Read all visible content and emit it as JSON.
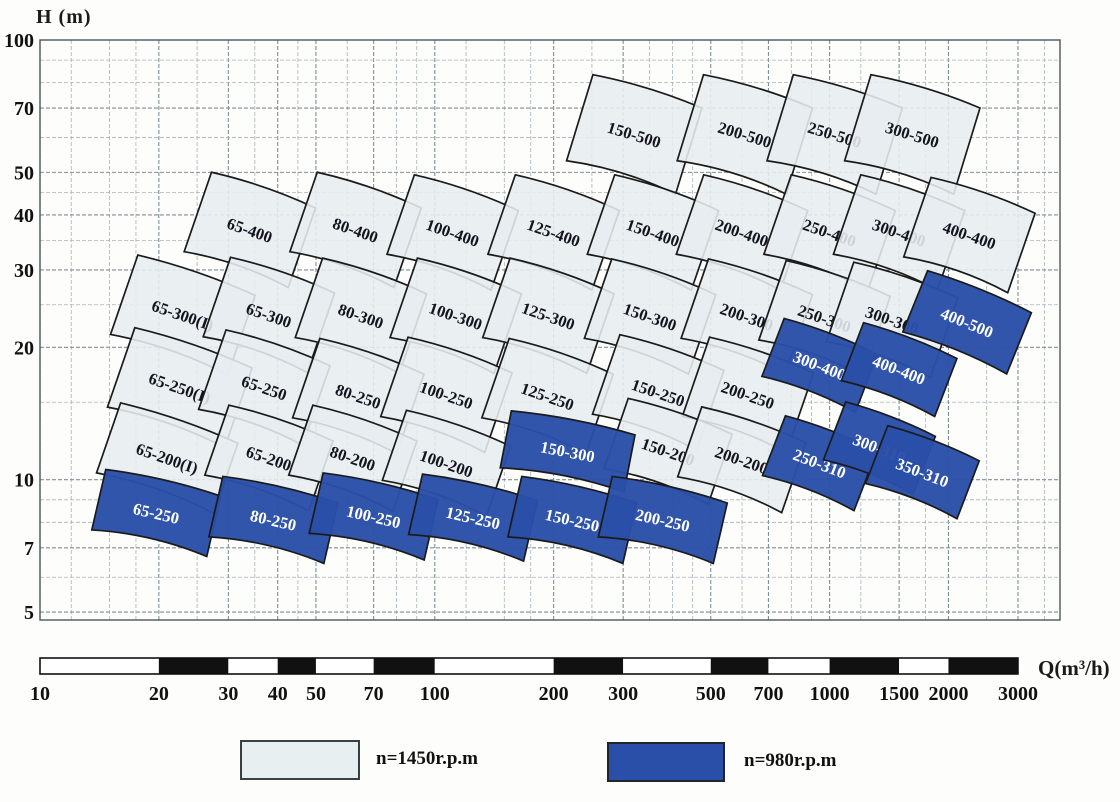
{
  "axes": {
    "y_title": "H  (m)",
    "x_title": "Q(m³/h)",
    "y_scale": "log",
    "x_scale": "log",
    "y_tick_labels": [
      100,
      70,
      50,
      40,
      30,
      20,
      10,
      7,
      5
    ],
    "x_tick_labels": [
      10,
      20,
      30,
      40,
      50,
      70,
      100,
      200,
      300,
      500,
      700,
      1000,
      1500,
      2000,
      3000
    ]
  },
  "legend": [
    {
      "label": "n=1450r.p.m",
      "rpm": 1450,
      "color": "#e8eff1",
      "border": "#3a3f44"
    },
    {
      "label": "n=980r.p.m",
      "rpm": 980,
      "color": "#2a4fa8",
      "border": "#22262b"
    }
  ],
  "colors": {
    "tile_light_fill": "#e7edf0",
    "tile_blue_fill": "#2a4fa8",
    "tile_stroke": "#1b1b1b",
    "tile_light_text": "#14141e",
    "tile_blue_text": "#ffffff",
    "grid_minor": "#a8b4b8",
    "grid_major": "#7f9095",
    "plot_border": "#4a5558",
    "scalebar_black": "#111111",
    "scalebar_white": "#ffffff"
  },
  "chart_data": {
    "type": "area",
    "title": "Pump model selection ranges (Q-H map)",
    "xlabel": "Q(m³/h)",
    "ylabel": "H (m)",
    "x_scale": "log",
    "y_scale": "log",
    "xlim": [
      10,
      3500
    ],
    "ylim": [
      5,
      100
    ],
    "grid": true,
    "legend_position": "bottom",
    "series": [
      {
        "name": "n=1450r.p.m",
        "rpm": 1450,
        "tiles": [
          {
            "label": "150-500",
            "q": 320,
            "h": 61
          },
          {
            "label": "200-500",
            "q": 610,
            "h": 61
          },
          {
            "label": "250-500",
            "q": 1030,
            "h": 61
          },
          {
            "label": "300-500",
            "q": 1620,
            "h": 61
          },
          {
            "label": "65-400",
            "q": 34,
            "h": 37
          },
          {
            "label": "80-400",
            "q": 63,
            "h": 37
          },
          {
            "label": "100-400",
            "q": 111,
            "h": 36.5
          },
          {
            "label": "125-400",
            "q": 200,
            "h": 36.5
          },
          {
            "label": "150-400",
            "q": 357,
            "h": 36.5
          },
          {
            "label": "200-400",
            "q": 600,
            "h": 36.5
          },
          {
            "label": "250-400",
            "q": 1000,
            "h": 36.5
          },
          {
            "label": "300-400",
            "q": 1500,
            "h": 36.5
          },
          {
            "label": "400-400",
            "q": 2260,
            "h": 36
          },
          {
            "label": "65-300(I)",
            "q": 23,
            "h": 23.7
          },
          {
            "label": "65-300",
            "q": 38,
            "h": 23.7
          },
          {
            "label": "80-300",
            "q": 65,
            "h": 23.6
          },
          {
            "label": "100-300",
            "q": 113,
            "h": 23.6
          },
          {
            "label": "125-300",
            "q": 194,
            "h": 23.6
          },
          {
            "label": "150-300",
            "q": 351,
            "h": 23.5
          },
          {
            "label": "200-300",
            "q": 617,
            "h": 23.5
          },
          {
            "label": "250-300",
            "q": 971,
            "h": 23.3
          },
          {
            "label": "300-300",
            "q": 1440,
            "h": 23.1
          },
          {
            "label": "65-250(I)",
            "q": 22.6,
            "h": 16.2
          },
          {
            "label": "65-250",
            "q": 37,
            "h": 16.2
          },
          {
            "label": "80-250",
            "q": 64,
            "h": 15.5
          },
          {
            "label": "100-250",
            "q": 107,
            "h": 15.6
          },
          {
            "label": "125-250",
            "q": 193,
            "h": 15.5
          },
          {
            "label": "150-250",
            "q": 368,
            "h": 15.8
          },
          {
            "label": "200-250",
            "q": 621,
            "h": 15.6
          },
          {
            "label": "65-200(I)",
            "q": 21,
            "h": 11.2
          },
          {
            "label": "65-200",
            "q": 38,
            "h": 11.2
          },
          {
            "label": "80-200",
            "q": 62,
            "h": 11.2
          },
          {
            "label": "100-200",
            "q": 107,
            "h": 10.9
          },
          {
            "label": "150-200",
            "q": 390,
            "h": 11.6
          },
          {
            "label": "200-200",
            "q": 599,
            "h": 11.1
          }
        ]
      },
      {
        "name": "n=980r.p.m",
        "rpm": 980,
        "tiles": [
          {
            "label": "400-500",
            "q": 2230,
            "h": 22.8
          },
          {
            "label": "300-400",
            "q": 944,
            "h": 18.2
          },
          {
            "label": "400-400",
            "q": 1500,
            "h": 17.8
          },
          {
            "label": "150-300",
            "q": 217,
            "h": 11.6
          },
          {
            "label": "250-310",
            "q": 944,
            "h": 10.9
          },
          {
            "label": "300-310",
            "q": 1337,
            "h": 11.8
          },
          {
            "label": "350-310",
            "q": 1718,
            "h": 10.4
          },
          {
            "label": "65-250",
            "q": 19.7,
            "h": 8.4
          },
          {
            "label": "80-250",
            "q": 39,
            "h": 8.1
          },
          {
            "label": "100-250",
            "q": 70,
            "h": 8.25
          },
          {
            "label": "125-250",
            "q": 125,
            "h": 8.2
          },
          {
            "label": "150-250",
            "q": 223,
            "h": 8.1
          },
          {
            "label": "200-250",
            "q": 378,
            "h": 8.1
          }
        ]
      }
    ]
  }
}
